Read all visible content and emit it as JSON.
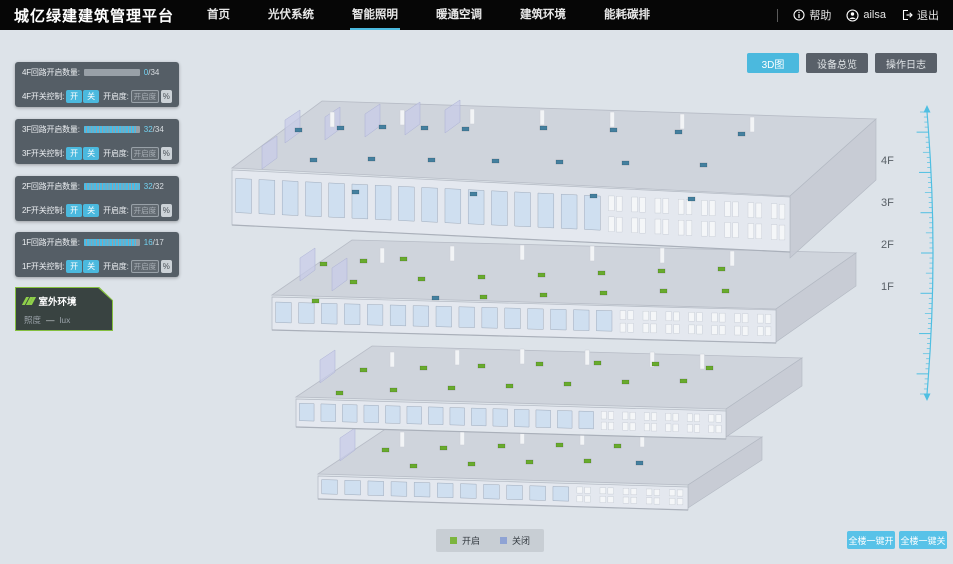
{
  "header": {
    "title": "城亿绿建建筑管理平台",
    "nav": [
      {
        "label": "首页",
        "active": false
      },
      {
        "label": "光伏系统",
        "active": false
      },
      {
        "label": "智能照明",
        "active": true
      },
      {
        "label": "暖通空调",
        "active": false
      },
      {
        "label": "建筑环境",
        "active": false
      },
      {
        "label": "能耗碳排",
        "active": false
      }
    ],
    "user": {
      "help": "帮助",
      "name": "ailsa",
      "logout": "退出"
    }
  },
  "view_buttons": [
    {
      "label": "3D图",
      "active": true
    },
    {
      "label": "设备总览",
      "active": false
    },
    {
      "label": "操作日志",
      "active": false
    }
  ],
  "floor_panels": [
    {
      "floor": "4F",
      "top": 32,
      "count_label": "4F回路开启数量:",
      "on": 0,
      "total": 34,
      "on_text": "0",
      "total_text": "/34",
      "switch_label": "4F开关控制:",
      "btn_on": "开",
      "btn_off": "关",
      "dim_label": "开启度:",
      "dim_placeholder": "开启度",
      "percent_label": "%"
    },
    {
      "floor": "3F",
      "top": 89,
      "count_label": "3F回路开启数量:",
      "on": 32,
      "total": 34,
      "on_text": "32",
      "total_text": "/34",
      "switch_label": "3F开关控制:",
      "btn_on": "开",
      "btn_off": "关",
      "dim_label": "开启度:",
      "dim_placeholder": "开启度",
      "percent_label": "%"
    },
    {
      "floor": "2F",
      "top": 146,
      "count_label": "2F回路开启数量:",
      "on": 32,
      "total": 32,
      "on_text": "32",
      "total_text": "/32",
      "switch_label": "2F开关控制:",
      "btn_on": "开",
      "btn_off": "关",
      "dim_label": "开启度:",
      "dim_placeholder": "开启度",
      "percent_label": "%"
    },
    {
      "floor": "1F",
      "top": 202,
      "count_label": "1F回路开启数量:",
      "on": 16,
      "total": 17,
      "on_text": "16",
      "total_text": "/17",
      "switch_label": "1F开关控制:",
      "btn_on": "开",
      "btn_off": "关",
      "dim_label": "开启度:",
      "dim_placeholder": "开启度",
      "percent_label": "%"
    }
  ],
  "env_panel": {
    "title": "室外环境",
    "metric": "照度",
    "value": "—",
    "unit": "lux"
  },
  "floor_labels": [
    {
      "label": "4F",
      "top": 125
    },
    {
      "label": "3F",
      "top": 167
    },
    {
      "label": "2F",
      "top": 209
    },
    {
      "label": "1F",
      "top": 251
    }
  ],
  "legend": [
    {
      "label": "开启",
      "color": "#7cb53e"
    },
    {
      "label": "关闭",
      "color": "#8fa3d4"
    }
  ],
  "bulk_buttons": [
    {
      "label": "全楼一键开"
    },
    {
      "label": "全楼一键关"
    }
  ],
  "colors": {
    "accent": "#4bb9de",
    "header_bg": "#060606",
    "stage_bg": "#dde3e9",
    "panel_bg": "rgba(73,82,90,0.92)",
    "env_border": "#84bf3f",
    "bulk_button": "#58c2e8",
    "marker_on": "#68ab2d",
    "marker_off": "#44809f"
  },
  "building": {
    "marker_on": "#68ab2d",
    "marker_off": "#44809f",
    "floors": [
      {
        "name": "4F",
        "plate": [
          [
            232,
            168
          ],
          [
            322,
            101
          ],
          [
            876,
            119
          ],
          [
            790,
            196
          ]
        ],
        "right": [
          [
            790,
            196
          ],
          [
            876,
            119
          ],
          [
            876,
            180
          ],
          [
            790,
            258
          ]
        ],
        "band": {
          "x1": 232,
          "y1": 170,
          "x2": 790,
          "y2": 197,
          "h": 55,
          "windows": 24
        },
        "partitions": [
          [
            285,
            120
          ],
          [
            325,
            117
          ],
          [
            365,
            114
          ],
          [
            405,
            112
          ],
          [
            445,
            110
          ],
          [
            262,
            146
          ]
        ],
        "pillars": [
          [
            330,
            112
          ],
          [
            400,
            110
          ],
          [
            470,
            109
          ],
          [
            540,
            110
          ],
          [
            610,
            112
          ],
          [
            680,
            114
          ],
          [
            750,
            117
          ]
        ],
        "markers": [
          [
            295,
            128,
            0
          ],
          [
            337,
            126,
            0
          ],
          [
            379,
            125,
            0
          ],
          [
            421,
            126,
            0
          ],
          [
            462,
            127,
            0
          ],
          [
            540,
            126,
            0
          ],
          [
            610,
            128,
            0
          ],
          [
            675,
            130,
            0
          ],
          [
            738,
            132,
            0
          ],
          [
            310,
            158,
            0
          ],
          [
            368,
            157,
            0
          ],
          [
            428,
            158,
            0
          ],
          [
            492,
            159,
            0
          ],
          [
            556,
            160,
            0
          ],
          [
            622,
            161,
            0
          ],
          [
            700,
            163,
            0
          ],
          [
            352,
            190,
            0
          ],
          [
            470,
            192,
            0
          ],
          [
            590,
            194,
            0
          ],
          [
            688,
            197,
            0
          ]
        ]
      },
      {
        "name": "3F",
        "plate": [
          [
            272,
            295
          ],
          [
            352,
            240
          ],
          [
            856,
            253
          ],
          [
            776,
            309
          ]
        ],
        "right": [
          [
            776,
            309
          ],
          [
            856,
            253
          ],
          [
            856,
            286
          ],
          [
            776,
            342
          ]
        ],
        "band": {
          "x1": 272,
          "y1": 297,
          "x2": 776,
          "y2": 310,
          "h": 33,
          "windows": 22
        },
        "partitions": [
          [
            300,
            258
          ],
          [
            332,
            268
          ]
        ],
        "pillars": [
          [
            380,
            248
          ],
          [
            450,
            246
          ],
          [
            520,
            245
          ],
          [
            590,
            246
          ],
          [
            660,
            248
          ],
          [
            730,
            251
          ]
        ],
        "markers": [
          [
            320,
            262,
            1
          ],
          [
            360,
            259,
            1
          ],
          [
            400,
            257,
            1
          ],
          [
            350,
            280,
            1
          ],
          [
            418,
            277,
            1
          ],
          [
            478,
            275,
            1
          ],
          [
            538,
            273,
            1
          ],
          [
            598,
            271,
            1
          ],
          [
            658,
            269,
            1
          ],
          [
            718,
            267,
            1
          ],
          [
            480,
            295,
            1
          ],
          [
            540,
            293,
            1
          ],
          [
            600,
            291,
            1
          ],
          [
            660,
            289,
            1
          ],
          [
            312,
            299,
            1
          ],
          [
            722,
            289,
            1
          ],
          [
            432,
            296,
            0
          ]
        ]
      },
      {
        "name": "2F",
        "plate": [
          [
            296,
            397
          ],
          [
            372,
            346
          ],
          [
            802,
            358
          ],
          [
            726,
            409
          ]
        ],
        "right": [
          [
            726,
            409
          ],
          [
            802,
            358
          ],
          [
            802,
            386
          ],
          [
            726,
            437
          ]
        ],
        "band": {
          "x1": 296,
          "y1": 399,
          "x2": 726,
          "y2": 411,
          "h": 28,
          "windows": 20
        },
        "partitions": [
          [
            320,
            360
          ]
        ],
        "pillars": [
          [
            390,
            352
          ],
          [
            455,
            350
          ],
          [
            520,
            349
          ],
          [
            585,
            350
          ],
          [
            650,
            352
          ],
          [
            700,
            354
          ]
        ],
        "markers": [
          [
            360,
            368,
            1
          ],
          [
            420,
            366,
            1
          ],
          [
            478,
            364,
            1
          ],
          [
            536,
            362,
            1
          ],
          [
            594,
            361,
            1
          ],
          [
            652,
            362,
            1
          ],
          [
            390,
            388,
            1
          ],
          [
            448,
            386,
            1
          ],
          [
            506,
            384,
            1
          ],
          [
            564,
            382,
            1
          ],
          [
            622,
            380,
            1
          ],
          [
            680,
            379,
            1
          ],
          [
            336,
            391,
            1
          ],
          [
            706,
            366,
            1
          ]
        ]
      },
      {
        "name": "1F",
        "plate": [
          [
            318,
            474
          ],
          [
            390,
            426
          ],
          [
            762,
            437
          ],
          [
            688,
            485
          ]
        ],
        "right": [
          [
            688,
            485
          ],
          [
            762,
            437
          ],
          [
            762,
            460
          ],
          [
            688,
            508
          ]
        ],
        "band": {
          "x1": 318,
          "y1": 476,
          "x2": 688,
          "y2": 487,
          "h": 23,
          "windows": 16
        },
        "partitions": [
          [
            340,
            438
          ]
        ],
        "pillars": [
          [
            400,
            432
          ],
          [
            460,
            430
          ],
          [
            520,
            429
          ],
          [
            580,
            430
          ],
          [
            640,
            432
          ]
        ],
        "markers": [
          [
            382,
            448,
            1
          ],
          [
            440,
            446,
            1
          ],
          [
            498,
            444,
            1
          ],
          [
            556,
            443,
            1
          ],
          [
            614,
            444,
            1
          ],
          [
            410,
            464,
            1
          ],
          [
            468,
            462,
            1
          ],
          [
            526,
            460,
            1
          ],
          [
            584,
            459,
            1
          ],
          [
            636,
            461,
            0
          ]
        ]
      }
    ]
  }
}
